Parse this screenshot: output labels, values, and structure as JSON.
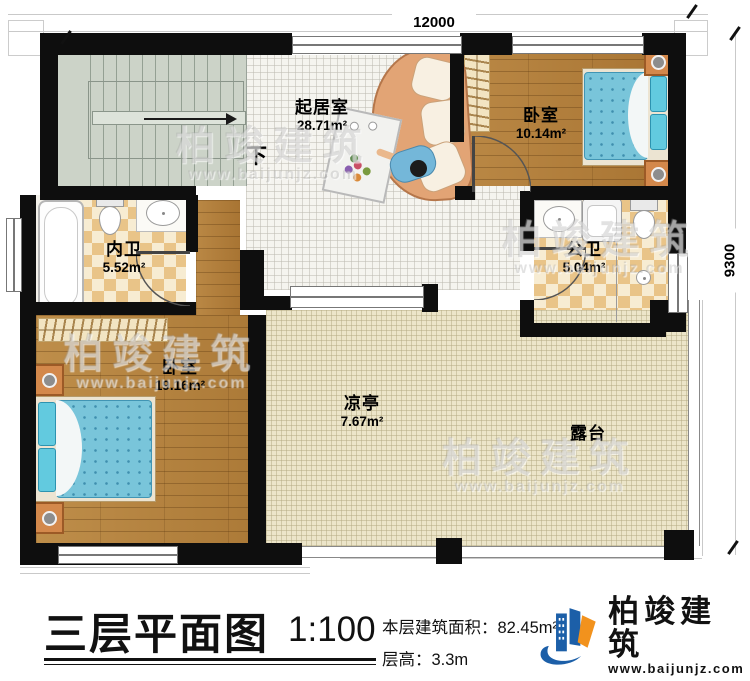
{
  "plan": {
    "dimensions": {
      "top_width": "12000",
      "right_height": "9300"
    },
    "stair_direction_label": "下",
    "rooms": [
      {
        "name": "起居室",
        "area": "28.71m²"
      },
      {
        "name": "卧室",
        "area": "10.14m²"
      },
      {
        "name": "内卫",
        "area": "5.52m²"
      },
      {
        "name": "公卫",
        "area": "5.04m²"
      },
      {
        "name": "卧室",
        "area": "19.16m²"
      },
      {
        "name": "凉亭",
        "area": "7.67m²"
      },
      {
        "name": "露台",
        "area": ""
      }
    ]
  },
  "watermark": {
    "brand": "柏竣建筑",
    "website": "www.baijunjz.com"
  },
  "title_block": {
    "plan_title": "三层平面图",
    "scale": "1:100",
    "floor_area_label": "本层建筑面积：",
    "floor_area_value": "82.45m²",
    "floor_height_label": "层高：",
    "floor_height_value": "3.3m",
    "brand_name": "柏竣建筑",
    "brand_website": "www.baijunjz.com"
  },
  "colors": {
    "wall": "#0e0e0e",
    "wood": "#b07c38",
    "tile_bath": "#e9c488",
    "terrace": "#ece5c9",
    "bed": "#79c5da",
    "brand_blue": "#1c5fa8",
    "brand_orange": "#f2921d"
  }
}
